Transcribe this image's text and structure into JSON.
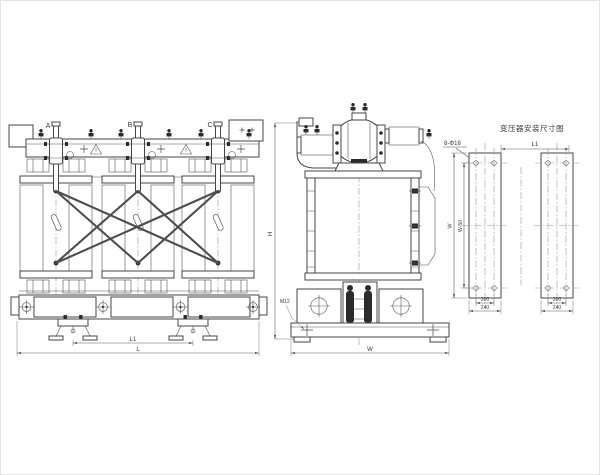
{
  "colors": {
    "ink": "#3f3f3f",
    "centerline": "#9a9a9a",
    "background": "#ffffff"
  },
  "front_view": {
    "phase_labels": [
      "A",
      "B",
      "C"
    ],
    "dim_l1": "L1",
    "dim_l": "L",
    "dim_h": "H"
  },
  "side_view": {
    "bolt_label": "M12",
    "dim_w": "W"
  },
  "detail_view": {
    "title": "变压器安装尺寸图",
    "holes_label": "8-Φ18",
    "dim_l1": "L1",
    "dim_w": "W",
    "dim_w50": "W-50",
    "dim_hole_spacing": "200",
    "dim_rail_width": "240"
  }
}
